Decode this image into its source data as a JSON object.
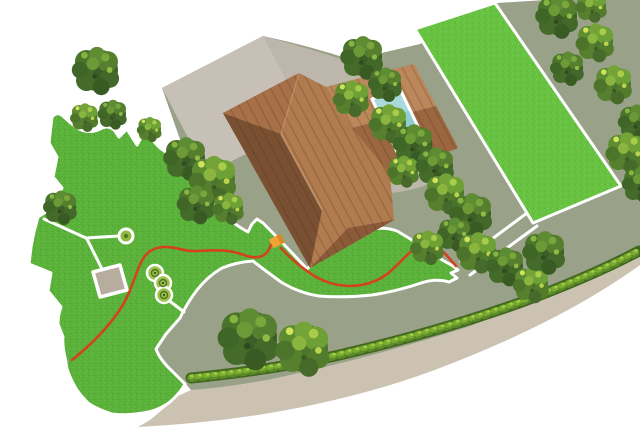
{
  "scene": {
    "type": "garden-site-plan-illustration",
    "description": "Top-down illustration of a property: house with brown hipped roof, grey driveway, swimming pool on a paved terrace, two white-bordered lawns, red robot-mower boundary wire with an orange charging station, white garden paths with a paved pad and three planting circles, tree groups, a roadside hedge and a curved road."
  },
  "objects": {
    "house": "hip-roofed house",
    "pool": "swimming pool",
    "driveway": "driveway",
    "terrace": "paved terrace",
    "lawn_main": "large irregular lawn with white border",
    "lawn_right": "rectangular lawn with white border",
    "boundary_wire": "red boundary wire",
    "charging_station": "orange charging station",
    "paved_pad": "small paved pad",
    "planting_circles": 3,
    "path_node": "round path node",
    "corridor": "white connecting passage",
    "hedge": "roadside hedge",
    "road": "curved road",
    "tree_count": 34
  },
  "colors": {
    "background": "#ffffff",
    "ground": "#9aa189",
    "driveway": "#c6c0b6",
    "terrace": "#bdb6aa",
    "road": "#cbc2b2",
    "lawn": "#5bb23a",
    "lawn_right": "#67c242",
    "lawn_border": "#ffffff",
    "path": "#ffffff",
    "pad": "#b7ad9e",
    "wire": "#d2421f",
    "station": "#f2a134",
    "station_dark": "#d88a22",
    "pool_water": "#8ecdd1",
    "pool_border": "#ffffff",
    "roof_base": "#b07b4e",
    "roof_dark": "#7a5033",
    "roof_hip": "#a87048",
    "roof_wing_top": "#bd875c",
    "roof_wing_bottom": "#9a6740",
    "roof_bottom_hip": "#8a5a39",
    "tree_dark": "#3c5e26",
    "tree_light": "#4c762c",
    "hedge_dark": "#40661f",
    "hedge_mid": "#5b8a28",
    "hedge_light": "#79ab31",
    "hedge_spark": "#a4cc43",
    "node_fill": "#8fb93f",
    "circle_fill": "#9dc24a"
  }
}
